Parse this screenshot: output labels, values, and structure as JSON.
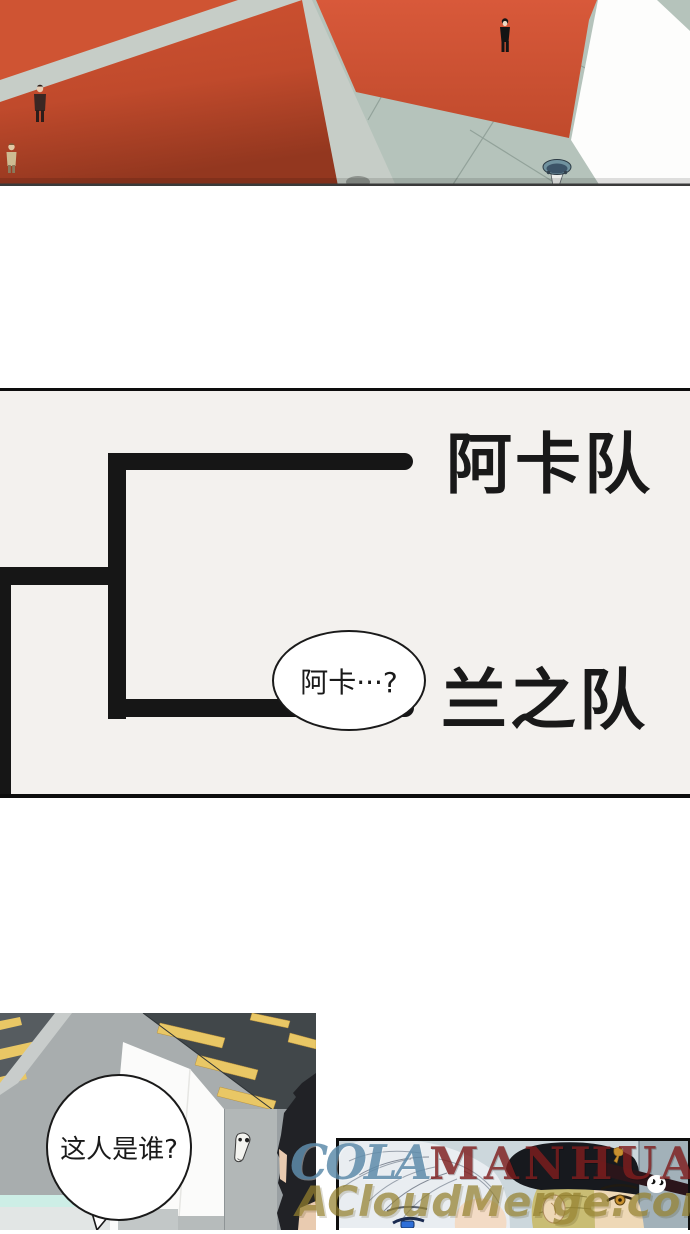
{
  "bracket_panel": {
    "team_top": "阿卡队",
    "team_bottom": "兰之队",
    "speech_bubble": "阿卡···?"
  },
  "hallway_panel": {
    "speech_bubble": "这人是谁?"
  },
  "watermarks": {
    "cola": "COLA",
    "manhua": "MANHUA",
    "dotcom": ".com",
    "acloudmerge": "ACloudMerge.com"
  },
  "colors": {
    "panel_bg": "#f3f1ee",
    "line_black": "#161616",
    "orange_tile": "#c84e2f",
    "orange_tile_bright": "#d5583a",
    "floor_green": "#b5c3bb",
    "walkway_gray": "#c6cdc7",
    "light_yellow": "#e9c765",
    "wm_blue": "#5f8cab",
    "wm_red": "#7e1d1d",
    "wm_olive": "#94802e",
    "cap_black": "#17191e",
    "eye_blue": "#2f6fd8",
    "eye_gold": "#c89030"
  }
}
